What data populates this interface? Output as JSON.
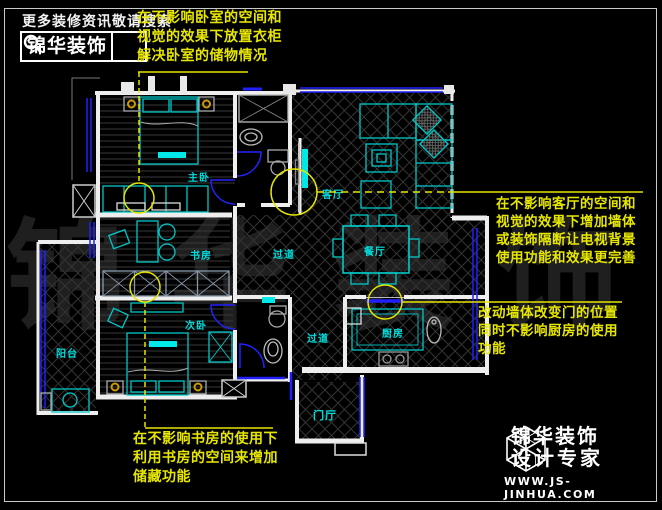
{
  "header": {
    "hint": "更多装修资讯敬请搜索",
    "logo_text": "锦华装饰",
    "search_icon": "magnifier"
  },
  "annotations": {
    "bedroom": {
      "lines": [
        "在不影响卧室的空间和",
        "视觉的效果下放置衣柜",
        "解决卧室的储物情况"
      ]
    },
    "living": {
      "lines": [
        "在不影响客厅的空间和",
        "视觉的效果下增加墙体",
        "或装饰隔断让电视背景",
        "使用功能和效果更完善"
      ]
    },
    "kitchen": {
      "lines": [
        "改动墙体改变门的位置",
        "同时不影响厨房的使用",
        "功能"
      ]
    },
    "study": {
      "lines": [
        "在不影响书房的使用下",
        "利用书房的空间来增加",
        "储藏功能"
      ]
    }
  },
  "floorplan": {
    "rooms": {
      "master": "主卧",
      "study": "书房",
      "second": "次卧",
      "balcony": "阳台",
      "living": "客厅",
      "hallway_upper": "过道",
      "dining": "餐厅",
      "hallway_lower": "过道",
      "kitchen": "厨房",
      "entry": "门厅"
    }
  },
  "brand": {
    "name": "锦华装饰",
    "tagline": "设计专家",
    "website": "WWW.JS-JINHUA.COM",
    "cube_icon": "cube-logo"
  },
  "watermark": "锦华装饰",
  "colors": {
    "annotation_yellow": "#e6e600",
    "furniture_cyan": "#00c8c8",
    "label_cyan": "#00dcdc",
    "window_blue": "#2020ff",
    "wall_white": "#f0f0f0",
    "background": "#000000"
  }
}
